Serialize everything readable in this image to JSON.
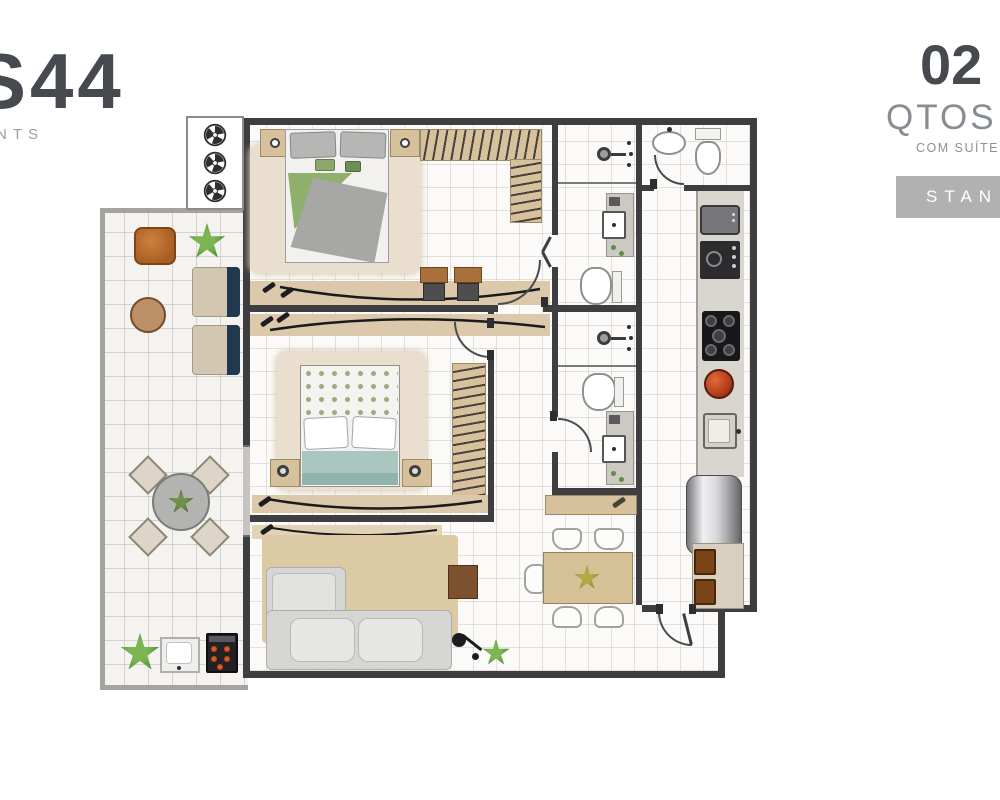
{
  "brand": {
    "logo_text": "S44",
    "logo_subtext": "NTS"
  },
  "unit": {
    "bedrooms_count": "02",
    "bedrooms_label": "QTOS",
    "bedrooms_note": "COM SUÍTE",
    "badge_label": "STAN"
  },
  "colors": {
    "text_dark": "#46494d",
    "text_gray": "#878d93",
    "badge_bg": "#b1b1b1",
    "badge_text": "#ffffff",
    "wall": "#3e3e40",
    "wood": "#d7c19d",
    "rug": "#eadfce",
    "accent_green": "#7cb654",
    "accent_navy": "#21394f",
    "accent_orange": "#c0732f",
    "accent_coal": "#e04a22"
  },
  "floorplan": {
    "rooms": [
      "suite-bedroom",
      "second-bedroom",
      "suite-bathroom",
      "bathroom-2",
      "lavabo",
      "kitchen",
      "living-room",
      "dining-area",
      "gourmet-balcony",
      "hall",
      "entry",
      "ac-condensers-area"
    ]
  }
}
